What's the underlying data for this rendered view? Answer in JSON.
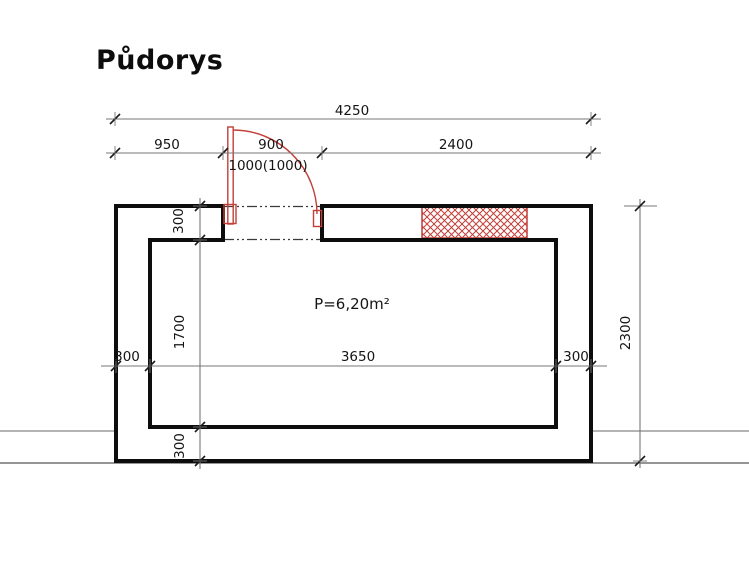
{
  "page": {
    "title": "Půdorys"
  },
  "plan": {
    "area_label": "P=6,20m²",
    "dims": {
      "total_width": "4250",
      "seg_left": "950",
      "seg_door": "900",
      "seg_right": "2400",
      "door_note": "1000(1000)",
      "wall_top": "300",
      "room_depth": "1700",
      "wall_bottom": "300",
      "wall_left": "300",
      "room_width": "3650",
      "wall_right": "300",
      "total_height": "2300"
    },
    "colors": {
      "wall_line": "#0d0d0d",
      "dimension_line": "#777777",
      "tick": "#1a1a1a",
      "door_red": "#c23f38",
      "guide_grey": "#9c9c9c",
      "guide_black": "#2b2b2b"
    }
  }
}
